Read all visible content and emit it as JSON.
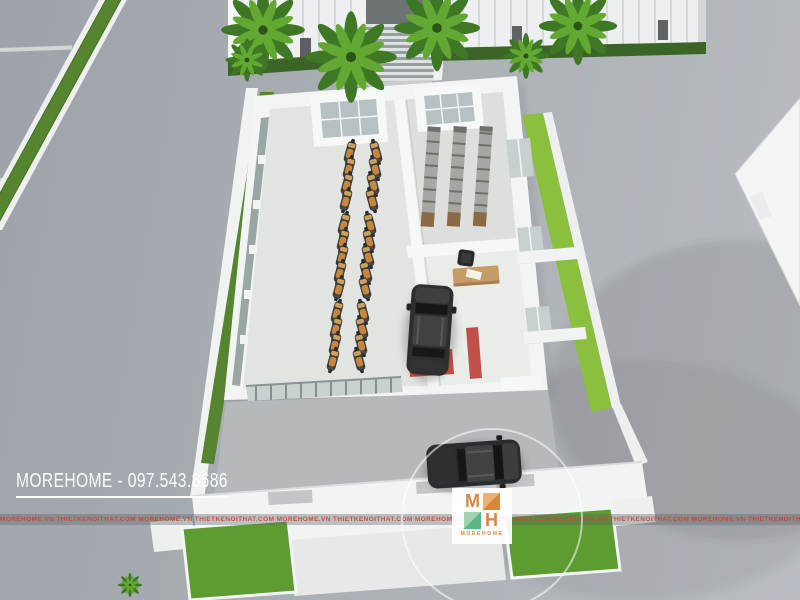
{
  "watermark": {
    "brand_phone": "MOREHOME - 097.543.8686"
  },
  "strip": {
    "text": "MOREHOME.VN    THIETKENOITHAT.COM MOREHOME.VN    THIETKENOITHAT.COM MOREHOME.VN    THIETKENOITHAT.COM MOREHOME.VN    THIETKENOITHAT.COM MOREHOME.VN    THIETKENOITHAT.COM MOREHOME.VN    THIETKENOITHAT.COM MOREHOME.VN    THIETKENOITHAT.COM MOREHOME.VN    THIETKENOITHAT.COM MOREHOME.VN"
  },
  "logo": {
    "m": "M",
    "h": "H",
    "caption": "MOREHOME",
    "orange": "#D8873E",
    "green": "#5FB487"
  },
  "scene": {
    "objects": [
      "street-pavement",
      "median-grass-strip",
      "background-building-facade",
      "palm-trees",
      "entrance-staircase",
      "hedge",
      "roof-canopy",
      "showroom-building",
      "display-motorbikes",
      "storage-racks",
      "service-bay-suv",
      "red-car-lift",
      "reception-desk",
      "office-chair",
      "forecourt-suv",
      "perimeter-wall",
      "grass-patches",
      "walkway"
    ],
    "motorbike_count": 26,
    "car_count": 2
  },
  "colors": {
    "road": "#A9AEB3",
    "wall_white": "#F2F4F4",
    "grass_bright": "#8BBF3E",
    "grass_dark": "#55852E",
    "hedge": "#3A6526",
    "lift_red": "#C0504A",
    "bike_orange": "#C8863C",
    "car_black": "#2A2C2D",
    "watermark_white": "#FFFFFF",
    "strip_red": "#C44536"
  }
}
